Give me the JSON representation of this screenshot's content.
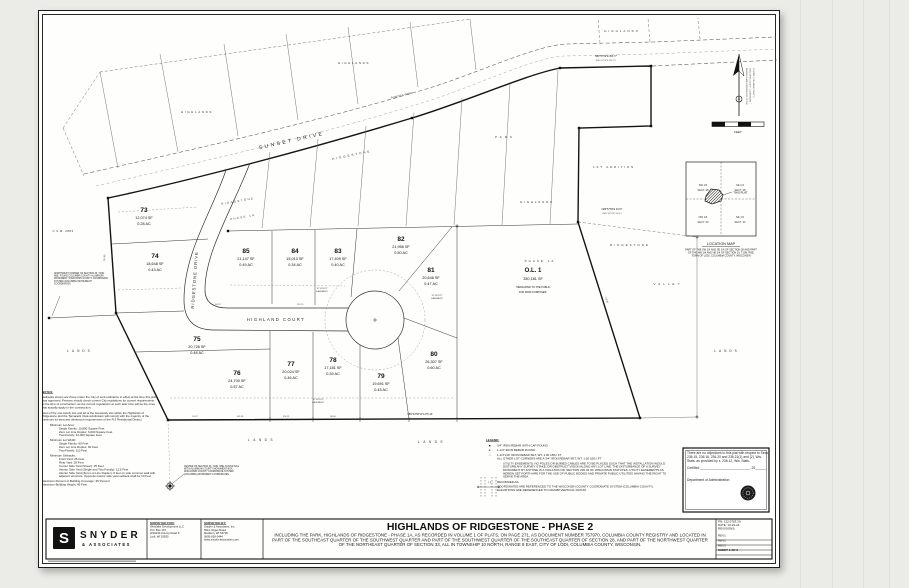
{
  "title_block": {
    "title": "HIGHLANDS OF RIDGESTONE - PHASE 2",
    "description": "INCLUDING THE PARK, HIGHLANDS OF RIDGESTONE - PHASE 1A, AS RECORDED IN VOLUME 1 OF PLATS, ON PAGE 271, AS DOCUMENT NUMBER 757970, COLUMBIA COUNTY REGISTRY AND LOCATED IN PART OF THE SOUTHEAST QUARTER OF THE SOUTHWEST QUARTER AND PART OF THE SOUTHWEST QUARTER OF THE SOUTHEAST QUARTER OF SECTION 28, AND PART OF THE NORTHWEST QUARTER OF THE NORTHEAST QUARTER OF SECTION 33, ALL IN TOWNSHIP 10 NORTH, RANGE 8 EAST, CITY OF LODI, COLUMBIA COUNTY, WISCONSIN.",
    "logo": {
      "mark": "S",
      "name": "SNYDER",
      "sub": "& ASSOCIATES"
    },
    "surveyed_for": {
      "label": "SURVEYED FOR:",
      "l1": "Westlake Development LLC",
      "l2": "P.O.  Box 167",
      "l3": "W10440 County Road K",
      "l4": "Lodi, WI 53555"
    },
    "surveyed_by": {
      "label": "SURVEYED BY:",
      "l1": "Snyder & Associates, Inc.",
      "l2": "5010 Voges Road",
      "l3": "Madison, WI 53718",
      "l4": "(608) 838-0444",
      "l5": "www.snyder-associates.com"
    },
    "info": {
      "pn": "PN: 122.0703.30",
      "date": "DATE: 10-22-24",
      "revisions_label": "REVISIONS:",
      "rev1": "REV1",
      "rev2": "REV2",
      "rev3": "REV3",
      "sheet": "SHEET 1 OF 2"
    }
  },
  "cert": {
    "body": "There are no objections to this plat with respect to Secs. 236.15, 236.16, 236.20 and 236.21(1) and (2), Wis. Stats. as provided by s. 236.12, Wis. Stats.",
    "certified": "Certified ___________________________, 20______",
    "dept": "Department of Administration"
  },
  "location_map": {
    "title": "LOCATION MAP",
    "nw1": "SW 1/4",
    "nw2": "SECT. 28",
    "ne1": "SE 1/4",
    "ne2": "SECT. 28",
    "sw1": "NW 1/4",
    "sw2": "SECT. 33",
    "se1": "NE 1/4",
    "se2": "SECT. 33",
    "this_plat": "THIS PLAT",
    "caption": "PART OF THE SW 1/4 AND SE 1/4 OF SECTION 28 AND PART OF THE NW 1/4 AND NE 1/4 OF SECTION 33, T10N, R8E, TOWN OF LODI, COLUMBIA COUNTY, WISCONSIN"
  },
  "legend": {
    "title": "LEGEND:",
    "i1": "3/4\" IRON REBAR WITH CAP FOUND",
    "i2": "1-1/4\" IRON REBAR FOUND",
    "i3": "1-1/4\"x30\" IRON REBAR SET, WT. 4.30 LBS / FT",
    "i3b": "ALL OTHER LOT CORNERS ARE A 3/4\" IRON REBAR SET, WT. 1.50 LBS / FT",
    "easement": "UTILITY EASEMENTS: NO POLES OR BURIED CABLES ARE TO BE PLACED SUCH THAT THE INSTALLATION WOULD DISTURB ANY SURVEY STAKE, OR OBSTRUCT VISION ALONG ANY LOT LINE. THE DISTURBANCE OF A SURVEY MONUMENT BY ANYONE IS A VIOLATION OF SECTION 236.32 OF WISCONSIN STATUTES. UTILITY EASEMENTS AS HEREIN SET FORTH ARE FOR THE USE OF PUBLIC BODIES AND PRIVATE PUBLIC UTILITIES HAVING THE RIGHT TO SERVE THE AREA.",
    "recorded_sym": "(  )",
    "recorded": "RECORDED AS",
    "coords": "COORDINATES ARE REFERENCED TO THE WISCONSIN COUNTY COORDINATE SYSTEM (COLUMBIA COUNTY). ELEVATIONS ARE REFERENCED TO NAVD88 VERTICAL DATUM."
  },
  "notes": {
    "title": "NOTES:",
    "p1": "Setbacks shown are those under the City of Lodi ordinance in effect at the time this plat was approved. Persons should check current City regulations for current requirements at the time of construction, as the current regulations at such later time will be the ones that actually apply to the construction.",
    "p2": "Most of the one-family lots and all of the two-family lots within the Highlands of Ridgestone and the Tamarack Vista subdivision will comply with the majority of the minimum lot area and dimension requirements of the R-2 Residential District",
    "g1_title": "Minimum Lot Area:",
    "g1": [
      "Single Family: 10,890 Square Feet",
      "Zero Lot Line Duplex: 6,000 Square Feet",
      "Two-Family: 12,000 Square Feet"
    ],
    "g2_title": "Minimum Lot Width:",
    "g2": [
      "Single Family: 80 Feet",
      "Zero Lot Line Duplex: 60 Feet",
      "Two-Family: 110 Feet"
    ],
    "g3_title": "Minimum Setbacks:",
    "g3": [
      "Front Yard: 25 Feet",
      "Rear Yard: 25 Feet",
      "Corner Side Yard (Street): 25 Feet",
      "Interior Side Yard (Single and Two-Family): 12.5 Feet",
      "Interior Side Yard (Zero Lot Line Duplex): 0 feet on side common wall with adjacent structure. Opposite interior side yard setback shall be 10 Feet"
    ],
    "t1": "Maximum Percent of Building Coverage: 35 Percent",
    "t2": "Maximum Building Height: 45 Feet"
  },
  "plat": {
    "streets": {
      "sunset": "SUNSET DRIVE",
      "ridgestone": "RIDGESTONE DRIVE",
      "highland": "HIGHLAND COURT"
    },
    "lots": [
      {
        "n": "73",
        "sf": "12,074 SF",
        "ac": "0.28 AC"
      },
      {
        "n": "74",
        "sf": "18,648 SF",
        "ac": "0.43 AC"
      },
      {
        "n": "75",
        "sf": "20,726 SF",
        "ac": "0.48 AC"
      },
      {
        "n": "76",
        "sf": "24,700 SF",
        "ac": "0.57 AC"
      },
      {
        "n": "77",
        "sf": "20,024 SF",
        "ac": "0.46 AC"
      },
      {
        "n": "78",
        "sf": "17,181 SF",
        "ac": "0.39 AC"
      },
      {
        "n": "79",
        "sf": "19,691 SF",
        "ac": "0.45 AC"
      },
      {
        "n": "80",
        "sf": "26,307 SF",
        "ac": "0.60 AC"
      },
      {
        "n": "81",
        "sf": "20,646 SF",
        "ac": "0.47 AC"
      },
      {
        "n": "82",
        "sf": "21,956 SF",
        "ac": "0.50 AC"
      },
      {
        "n": "83",
        "sf": "17,409 SF",
        "ac": "0.40 AC"
      },
      {
        "n": "84",
        "sf": "15,013 SF",
        "ac": "0.34 AC"
      },
      {
        "n": "85",
        "sf": "21,147 SF",
        "ac": "0.49 AC"
      }
    ],
    "outlot": {
      "name": "O.L. 1",
      "sf": "330,181 SF",
      "ded1": "\"DEDICATED TO THE PUBLIC",
      "ded2": "FOR PARK PURPOSES\""
    },
    "adj": {
      "highlands": "HIGHLANDS",
      "ridgestone": "RIDGESTONE",
      "phase1a": "PHASE 1A",
      "first_addition": "1ST ADDITION",
      "valley": "VALLEY",
      "lands": "LANDS",
      "park": "PARK",
      "csm": "C.S.M. 2883"
    },
    "bearings": {
      "b1": "N89°57'59\"E  354.77'",
      "b2": "(N89°13'13\"E  354.77')",
      "b3": "S89°33'56\"W  1175.14'",
      "b4": "N89°57'59\"E  33.97'",
      "b5": "(N89°13'13\"E  33.41')",
      "curve": "R=487.50'   L=233.62'",
      "d1": "61.87",
      "d2": "101.58",
      "d3": "118.13",
      "d4": "88.00",
      "d5": "84.97",
      "d6": "176.73",
      "d7": "178.30",
      "d8": "124.98"
    },
    "easement_label1": "12' UTILITY",
    "easement_label2": "EASEMENT",
    "corner_nw": "NORTHWEST CORNER OF SECTION 33, T10N, R8E, FOUND COLUMBIA COUNTY ALUMINUM MONUMENT. WISCONSIN COUNTY COORDINATE SYSTEM (COLUMBIA) MONUMENT COORDINATES.",
    "corner_center": "CENTER OF SECTION 33, T10N, R8E, FOUND NAIL WITH ALUMINUM COUNTY MONUMENT BOX. WISCONSIN COUNTY COORDINATE SYSTEM (COLUMBIA) MONUMENT COORDINATES.",
    "north_note1": "BEARINGS ARE REFERENCED TO THE",
    "north_note2": "WISCONSIN COUNTY COORDINATE",
    "north_note3": "SYSTEM (COLUMBIA COUNTY)",
    "scale_label": "FEET"
  }
}
